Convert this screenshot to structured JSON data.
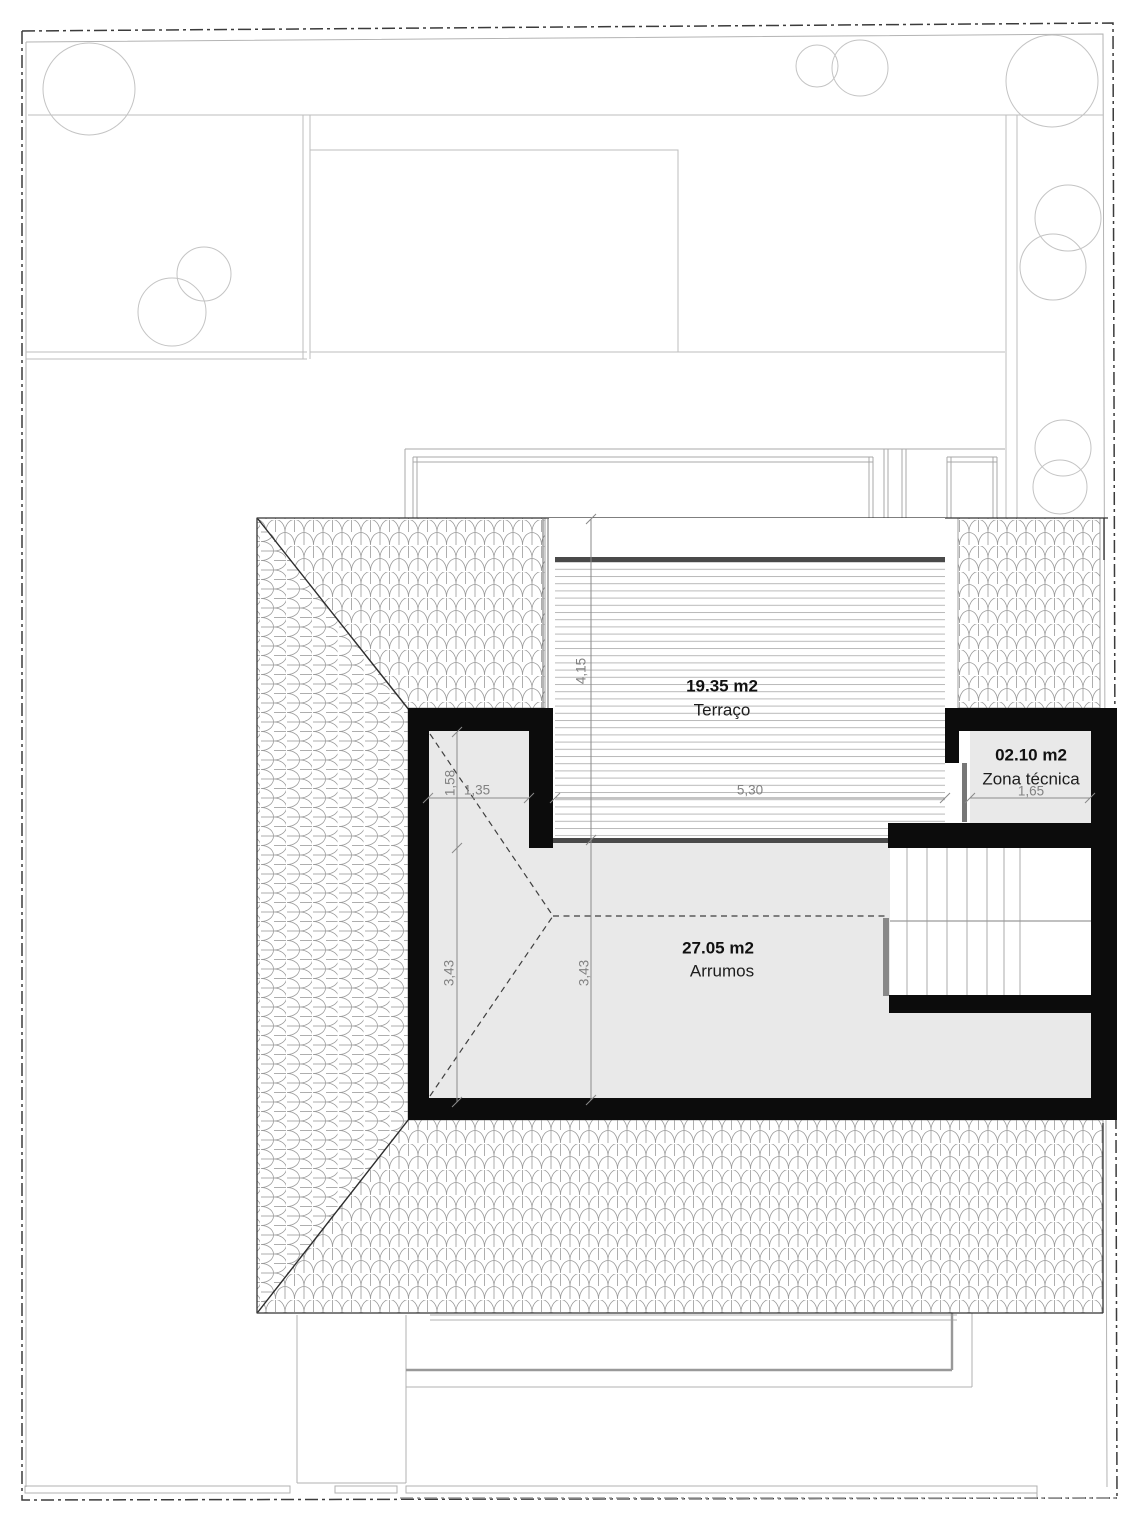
{
  "plan_title": "Roof level floor plan",
  "rooms": {
    "terraco": {
      "area": "19.35 m2",
      "name": "Terraço"
    },
    "arrumos": {
      "area": "27.05 m2",
      "name": "Arrumos"
    },
    "zona_tecnica": {
      "area": "02.10 m2",
      "name": "Zona técnica"
    }
  },
  "dimensions": {
    "terrace_depth": "4,15",
    "terrace_width": "5,30",
    "niche_width": "1,35",
    "niche_depth": "1,58",
    "zona_width": "1,65",
    "arrumos_height_left": "3,43",
    "arrumos_height_right": "3,43"
  },
  "colors": {
    "wall": "#0c0c0c",
    "room_fill": "#e9e9e9",
    "deck_line": "#b9b9b9",
    "deck_bar": "#4a4a4a",
    "tile_stroke": "#9a9a9a",
    "dimension": "#8a8a8a",
    "boundary": "#3b3b3b",
    "site_line": "#b9b9b9"
  }
}
